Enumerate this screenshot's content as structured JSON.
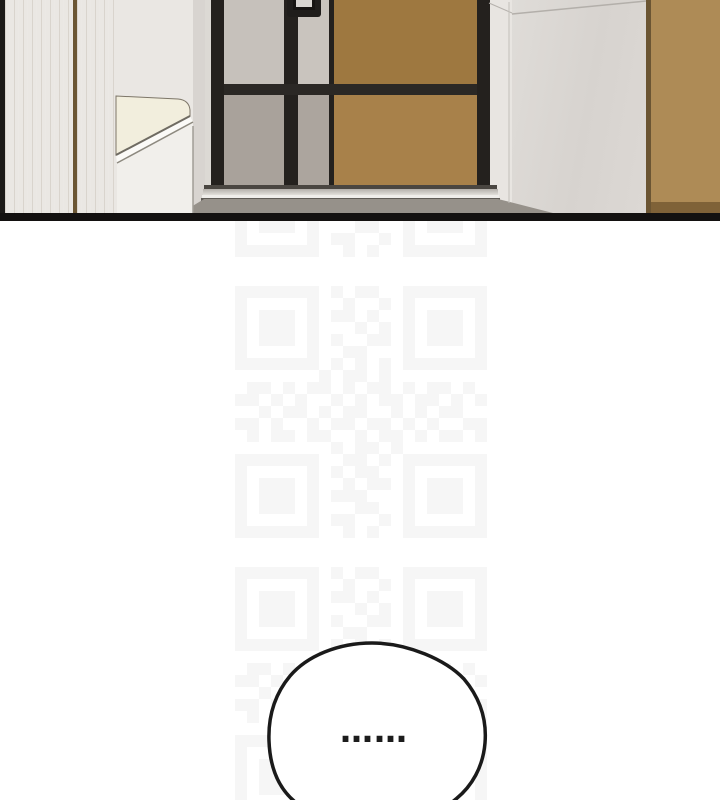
{
  "page": {
    "width": 720,
    "height": 800,
    "background": "#ffffff"
  },
  "comic_panel": {
    "description": "apartment entryway interior: black-framed front door with gray and wood panels, digital door lock, shoe bench at left, marble and wood wall panels at right",
    "palette": {
      "wood_left": "#c09a63",
      "wood_right": "#ae8b56",
      "wall": "#eae7e3",
      "door_frame": "#24211e",
      "door_panel_gray_top": "#c6c1bb",
      "door_panel_gray_bottom": "#a9a29b",
      "door_wood_top": "#9e7840",
      "door_wood_bottom": "#a8814a",
      "bench_seat": "#f2eedd",
      "bench_front": "#f1efeb",
      "marble_wall": "#dcd9d5",
      "threshold_silver": "#d6d3ce",
      "floor": "#96918a",
      "panel_border": "#131110"
    }
  },
  "watermark": {
    "color": "#f6f6f6",
    "module_px": 12,
    "x": 235,
    "tile_ys": [
      5,
      286,
      567
    ],
    "matrix": [
      "111111101011001111111",
      "100000100100101000001",
      "101110101101001011101",
      "101110100010101011101",
      "101110101001101011101",
      "100000100110001000001",
      "111111101010101111111",
      "000000010110100000000",
      "011010110101101011010",
      "110101001010110110101",
      "001011010110010101100",
      "110100101101101010011",
      "010110110010110101101",
      "000000001011010000000",
      "111111100110101111111",
      "100000101011001000001",
      "101110100101101011101",
      "101110101110001011101",
      "101110100011001011101",
      "100000101100101000001",
      "111111100101001111111"
    ]
  },
  "speech_bubble": {
    "text": "……",
    "fill": "#ffffff",
    "stroke": "#1a1a1a"
  }
}
